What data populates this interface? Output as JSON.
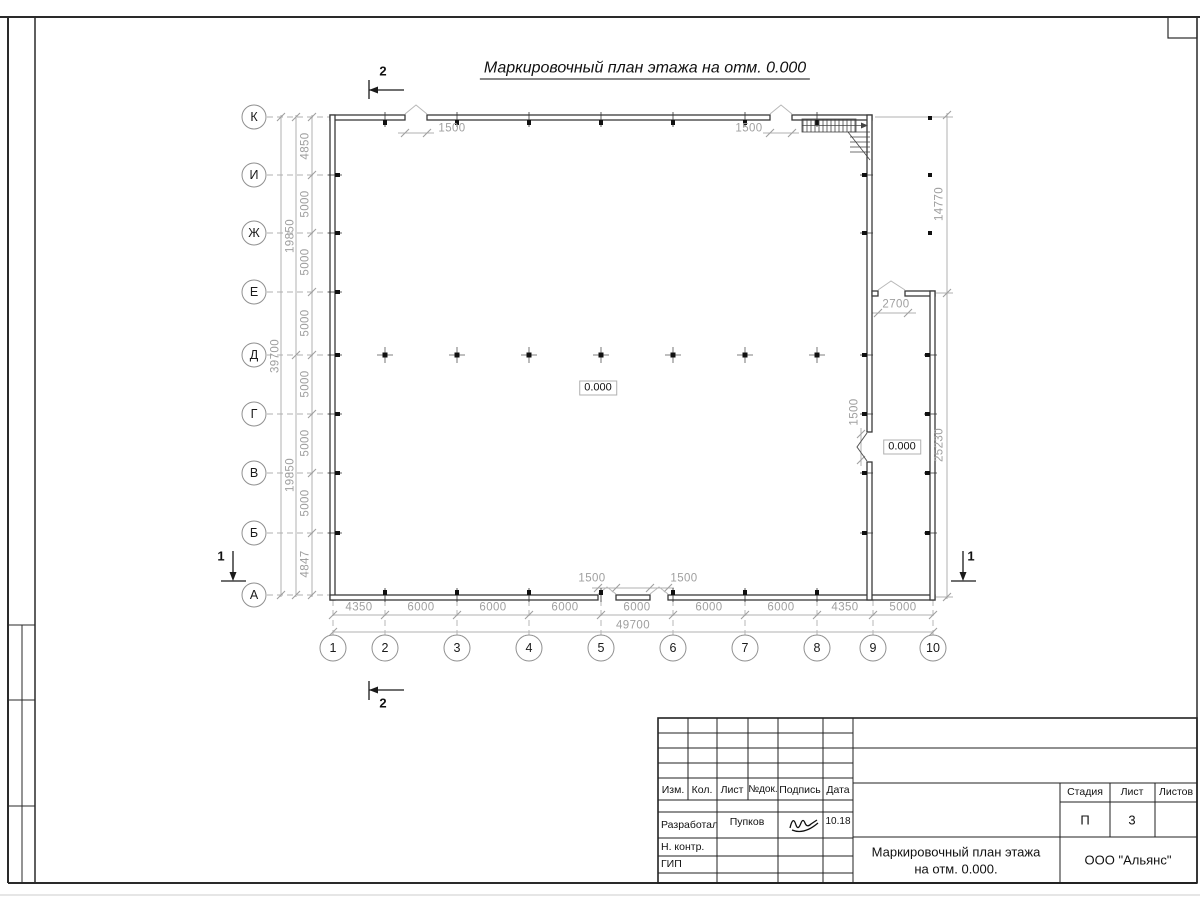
{
  "sheet": {
    "title": "Маркировочный план этажа на отм. 0.000"
  },
  "palette": {
    "wall": "#3a3a3a",
    "dimension": "#9f9f9f",
    "background": "#ffffff"
  },
  "axes": {
    "rows": [
      "К",
      "И",
      "Ж",
      "Е",
      "Д",
      "Г",
      "В",
      "Б",
      "А"
    ],
    "cols": [
      "1",
      "2",
      "3",
      "4",
      "5",
      "6",
      "7",
      "8",
      "9",
      "10"
    ]
  },
  "dimensions": {
    "left_segments": [
      "4850",
      "5000",
      "5000",
      "5000",
      "5000",
      "5000",
      "5000",
      "4847"
    ],
    "left_groups": [
      "19850",
      "19850"
    ],
    "left_total": "39700",
    "bottom_segments": [
      "4350",
      "6000",
      "6000",
      "6000",
      "6000",
      "6000",
      "6000",
      "4350",
      "5000"
    ],
    "bottom_total": "49700",
    "right_upper": "14770",
    "right_lower": "25230",
    "openings": {
      "top_left": "1500",
      "top_right": "1500",
      "bottom_left": "1500",
      "bottom_right": "1500",
      "annex_top": "2700",
      "right_door": "1500"
    }
  },
  "marks": {
    "elevation_hall": "0.000",
    "elevation_annex": "0.000",
    "section_top": "2",
    "section_bottom": "2",
    "section_left": "1",
    "section_right": "1"
  },
  "title_block": {
    "headers": {
      "izm": "Изм.",
      "kol": "Кол.",
      "list": "Лист",
      "ndok": "№док.",
      "podpis": "Подпись",
      "data": "Дата"
    },
    "rows": {
      "developed_label": "Разработал",
      "developed_name": "Пупков",
      "developed_date": "10.18",
      "ncontr_label": "Н. контр.",
      "gip_label": "ГИП"
    },
    "right": {
      "stage_label": "Стадия",
      "sheet_label": "Лист",
      "sheets_label": "Листов",
      "stage_value": "П",
      "sheet_value": "3",
      "sheets_value": ""
    },
    "doc_title_line1": "Маркировочный план этажа",
    "doc_title_line2": "на отм. 0.000.",
    "company": "ООО \"Альянс\""
  }
}
